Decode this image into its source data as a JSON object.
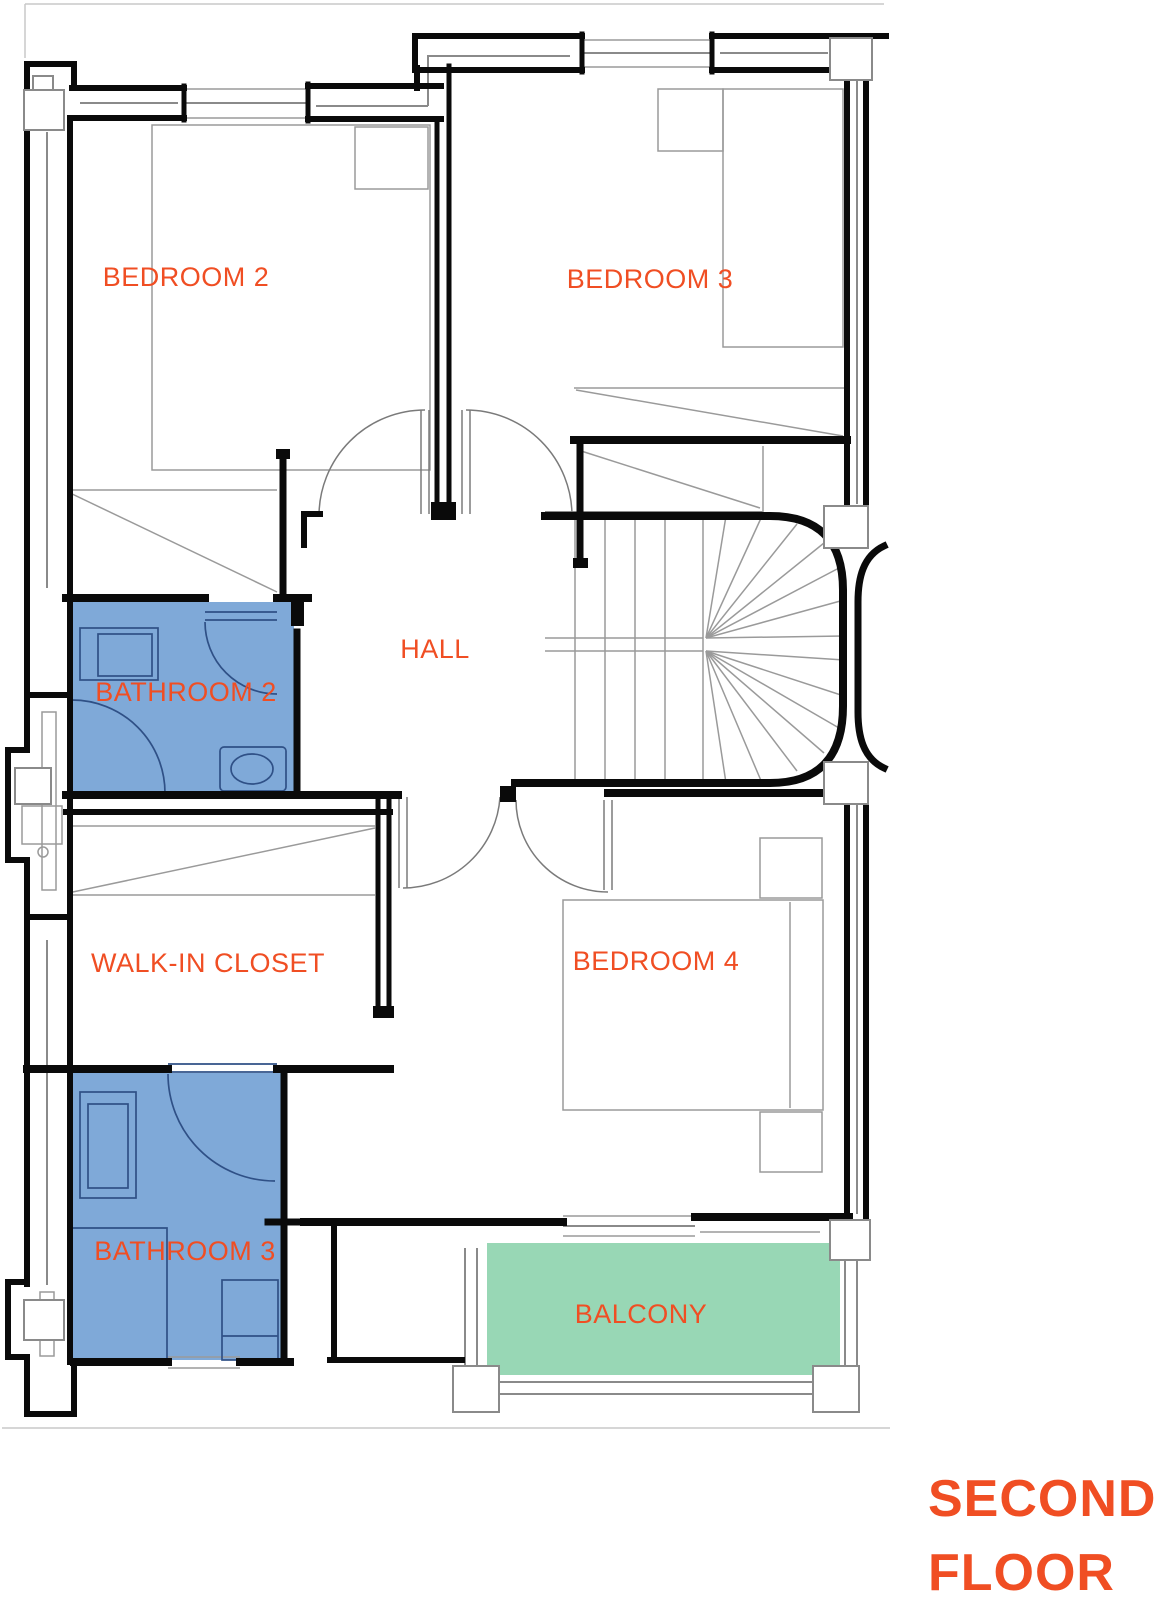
{
  "floor_plan": {
    "title": {
      "line1": "SECOND",
      "line2": "FLOOR"
    },
    "rooms": [
      {
        "id": "bedroom-2",
        "label": "BEDROOM 2"
      },
      {
        "id": "bedroom-3",
        "label": "BEDROOM 3"
      },
      {
        "id": "hall",
        "label": "HALL"
      },
      {
        "id": "bathroom-2",
        "label": "BATHROOM 2"
      },
      {
        "id": "walk-in-closet",
        "label": "WALK-IN CLOSET"
      },
      {
        "id": "bathroom-3",
        "label": "BATHROOM 3"
      },
      {
        "id": "bedroom-4",
        "label": "BEDROOM 4"
      },
      {
        "id": "balcony",
        "label": "BALCONY"
      }
    ],
    "colors": {
      "label": "#F04E23",
      "wall": "#0a0a0a",
      "thin_line": "#8a8a8a",
      "bathroom_fill": "#7FA9D8",
      "bathroom_line": "#2f5086",
      "balcony_fill": "#98D7B5"
    }
  }
}
